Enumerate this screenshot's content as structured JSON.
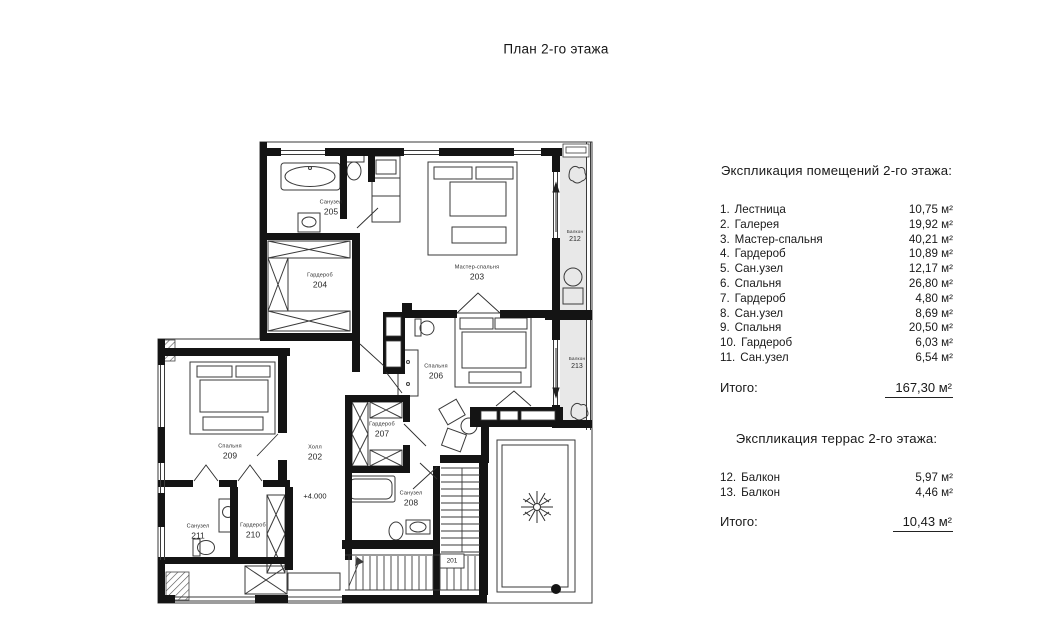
{
  "title": "План 2-го этажа",
  "plan": {
    "level_mark": "+4.000",
    "rooms": {
      "r201": {
        "number": "201"
      },
      "r202": {
        "name": "Холл",
        "number": "202"
      },
      "r203": {
        "name": "Мастер-спальня",
        "number": "203"
      },
      "r204": {
        "name": "Гардероб",
        "number": "204"
      },
      "r205": {
        "name": "Санузел",
        "number": "205"
      },
      "r206": {
        "name": "Спальня",
        "number": "206"
      },
      "r207": {
        "name": "Гардероб",
        "number": "207"
      },
      "r208": {
        "name": "Санузел",
        "number": "208"
      },
      "r209": {
        "name": "Спальня",
        "number": "209"
      },
      "r210": {
        "name": "Гардероб",
        "number": "210"
      },
      "r211": {
        "name": "Санузел",
        "number": "211"
      },
      "r212": {
        "name": "Балкон",
        "number": "212"
      },
      "r213": {
        "name": "Балкон",
        "number": "213"
      }
    }
  },
  "explication_rooms": {
    "header": "Экспликация помещений 2-го этажа:",
    "rows": [
      {
        "index": "1.",
        "label": "Лестница",
        "area": "10,75 м²"
      },
      {
        "index": "2.",
        "label": "Галерея",
        "area": "19,92 м²"
      },
      {
        "index": "3.",
        "label": "Мастер-спальня",
        "area": "40,21 м²"
      },
      {
        "index": "4.",
        "label": "Гардероб",
        "area": "10,89 м²"
      },
      {
        "index": "5.",
        "label": "Сан.узел",
        "area": "12,17 м²"
      },
      {
        "index": "6.",
        "label": "Спальня",
        "area": "26,80 м²"
      },
      {
        "index": "7.",
        "label": "Гардероб",
        "area": "4,80 м²"
      },
      {
        "index": "8.",
        "label": "Сан.узел",
        "area": "8,69 м²"
      },
      {
        "index": "9.",
        "label": "Спальня",
        "area": "20,50 м²"
      },
      {
        "index": "10.",
        "label": "Гардероб",
        "area": "6,03 м²"
      },
      {
        "index": "11.",
        "label": "Сан.узел",
        "area": "6,54 м²"
      }
    ],
    "total_label": "Итого:",
    "total_value": "167,30 м²"
  },
  "explication_terraces": {
    "header": "Экспликация террас 2-го этажа:",
    "rows": [
      {
        "index": "12.",
        "label": "Балкон",
        "area": "5,97 м²"
      },
      {
        "index": "13.",
        "label": "Балкон",
        "area": "4,46 м²"
      }
    ],
    "total_label": "Итого:",
    "total_value": "10,43 м²"
  },
  "colors": {
    "wall": "#141414",
    "balcony_fill": "#e8e8e8",
    "text": "#1c1c1c"
  }
}
